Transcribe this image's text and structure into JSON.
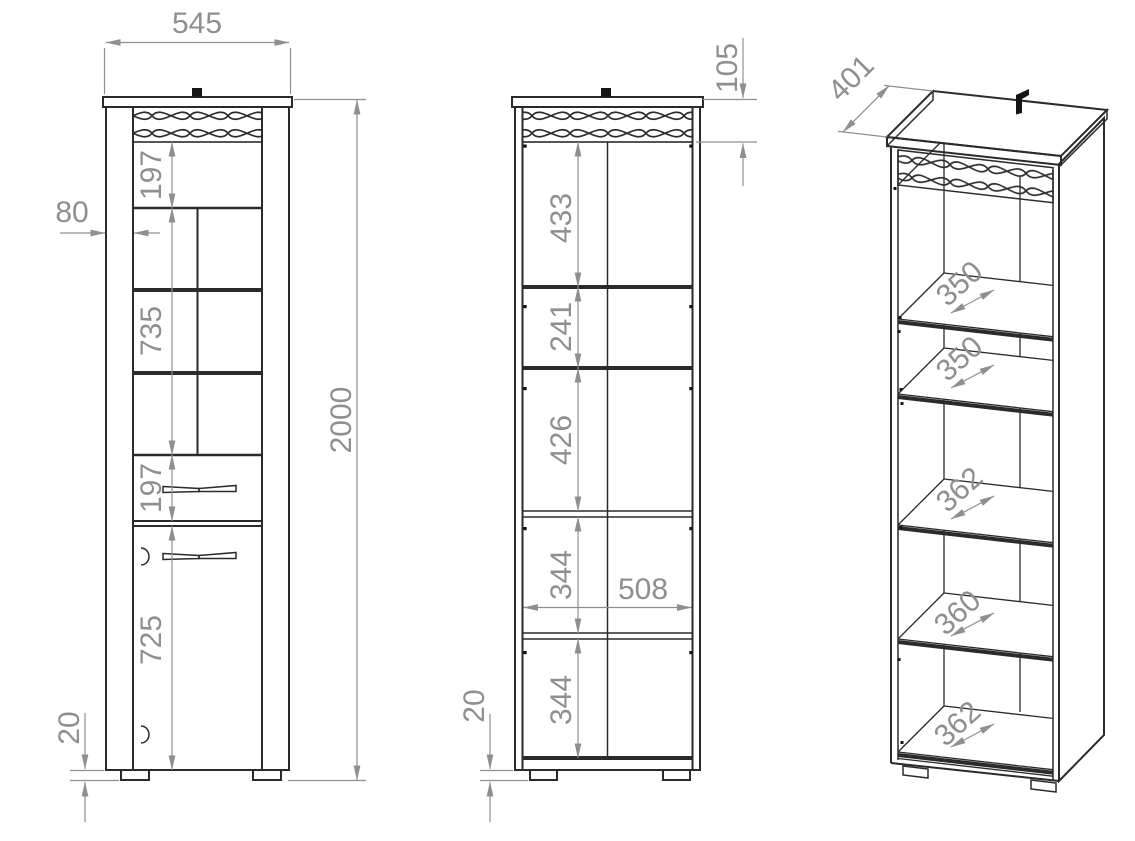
{
  "drawing": {
    "front_view": {
      "width": "545",
      "height": "2000",
      "side_offset": "80",
      "sections": [
        "197",
        "735",
        "197",
        "725"
      ],
      "foot_height": "20"
    },
    "section_view": {
      "top_panel": "105",
      "sections": [
        "433",
        "241",
        "426",
        "344",
        "344"
      ],
      "inner_width": "508",
      "foot_height": "20"
    },
    "iso_view": {
      "depth": "401",
      "shelf_depths": [
        "350",
        "350",
        "362",
        "360",
        "362"
      ]
    },
    "colors": {
      "line": "#2b2b2b",
      "dimension": "#8f8f8f",
      "background": "#ffffff"
    }
  }
}
